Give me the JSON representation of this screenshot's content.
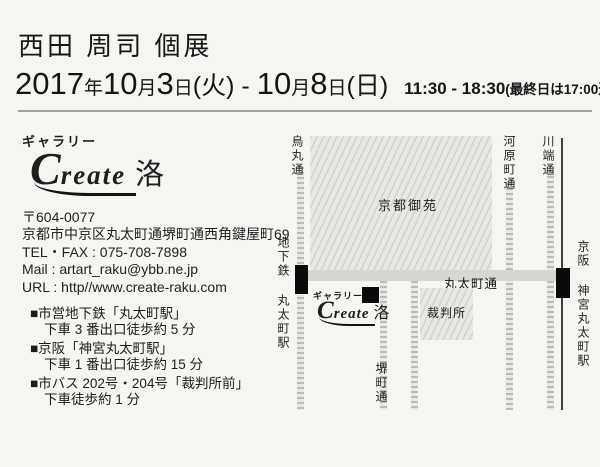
{
  "header": {
    "title": "西田 周司 個展",
    "date_parts": [
      "2017",
      "年",
      "10",
      "月",
      "3",
      "日",
      "(火)",
      "-",
      "10",
      "月",
      "8",
      "日",
      "(日)"
    ],
    "time_range": "11:30 - 18:30",
    "time_note": "(最終日は17:00迄)"
  },
  "gallery": {
    "type_label": "ギャラリー",
    "logo_c": "C",
    "logo_rest": "reate",
    "logo_kanji": "洛"
  },
  "contact": {
    "postal": "〒604-0077",
    "address": "京都市中京区丸太町通堺町通西角鍵屋町69",
    "tel_fax": "TEL・FAX : 075-708-7898",
    "mail": "Mail : artart_raku@ybb.ne.jp",
    "url": "URL : http//www.create-raku.com"
  },
  "access": {
    "items": [
      {
        "head": "■市営地下鉄「丸太町駅」",
        "detail": "下車 3 番出口徒歩約 5 分"
      },
      {
        "head": "■京阪「神宮丸太町駅」",
        "detail": "下車 1 番出口徒歩約 15 分"
      },
      {
        "head": "■市バス 202号・204号「裁判所前」",
        "detail": "下車徒歩約 1 分"
      }
    ]
  },
  "map": {
    "park_label": "京都御苑",
    "court_label": "裁判所",
    "streets": {
      "karasuma": "烏丸通",
      "kawaramachi": "河原町通",
      "kawabata": "川端通",
      "marutamachi": "丸太町通",
      "sakaimachi": "堺町通"
    },
    "stations": {
      "subway": "地下鉄 丸太町駅",
      "keihan": "京阪 神宮丸太町駅"
    },
    "gallery_label": "ギャラリー",
    "logo_c": "C",
    "logo_rest": "reate",
    "logo_kanji": "洛"
  },
  "colors": {
    "paper": "#f6f5f2",
    "ink": "#1e1e1e",
    "street_gray": "#bdbcb8",
    "band_gray": "#d7d6d1",
    "station_black": "#0b0b0b",
    "rule_gray": "#a0a09d"
  }
}
